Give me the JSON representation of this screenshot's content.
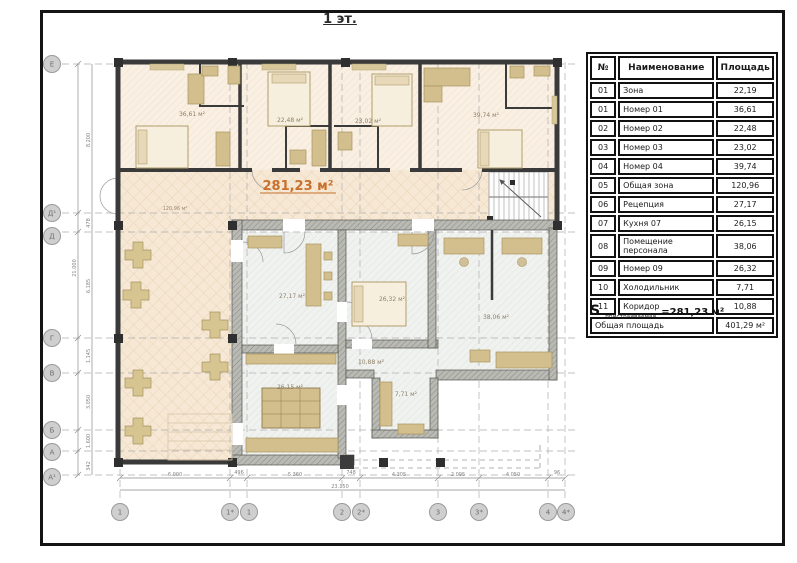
{
  "title": "1 эт.",
  "accent_color": "#c8702d",
  "legend_table": {
    "headers": [
      "№",
      "Наименование",
      "Площадь"
    ],
    "rows": [
      {
        "num": "01",
        "name": "Зона",
        "area": "22,19"
      },
      {
        "num": "01",
        "name": "Номер 01",
        "area": "36,61"
      },
      {
        "num": "02",
        "name": "Номер 02",
        "area": "22,48"
      },
      {
        "num": "03",
        "name": "Номер 03",
        "area": "23,02"
      },
      {
        "num": "04",
        "name": "Номер 04",
        "area": "39,74"
      },
      {
        "num": "05",
        "name": "Общая зона",
        "area": "120,96"
      },
      {
        "num": "06",
        "name": "Рецепция",
        "area": "27,17"
      },
      {
        "num": "07",
        "name": "Кухня 07",
        "area": "26,15"
      },
      {
        "num": "08",
        "name": "Помещение персонала",
        "area": "38,06"
      },
      {
        "num": "09",
        "name": "Номер 09",
        "area": "26,32"
      },
      {
        "num": "10",
        "name": "Холодильник",
        "area": "7,71"
      },
      {
        "num": "11",
        "name": "Коридор",
        "area": "10,88"
      }
    ],
    "footer": {
      "name": "Общая площадь",
      "area": "401,29 м²"
    }
  },
  "s_annotation": {
    "symbol": "S",
    "subscript": "пристраиваемая",
    "value": "=281,23 м²"
  },
  "plan": {
    "highlight_area_label": "281,23 м²",
    "room_labels": [
      {
        "room": "Номер 01",
        "text": "36,61 м²"
      },
      {
        "room": "Номер 02",
        "text": "22,48 м²"
      },
      {
        "room": "Номер 03",
        "text": "23,02 м²"
      },
      {
        "room": "Номер 04",
        "text": "39,74 м²"
      },
      {
        "room": "Общая зона",
        "text": "120,96 м²"
      },
      {
        "room": "Рецепция",
        "text": "27,17 м²"
      },
      {
        "room": "Номер 09",
        "text": "26,32 м²"
      },
      {
        "room": "Помещение персонала",
        "text": "38,06 м²"
      },
      {
        "room": "Коридор",
        "text": "10,88 м²"
      },
      {
        "room": "Кухня",
        "text": "26,15 м²"
      },
      {
        "room": "Холодильник",
        "text": "7,71 м²"
      }
    ],
    "axes": {
      "left": [
        "Е",
        "Д¹",
        "Д",
        "Г",
        "В",
        "Б",
        "А",
        "А¹"
      ],
      "bottom": [
        "1",
        "1*",
        "1",
        "2",
        "2*",
        "3",
        "3*",
        "4",
        "4*"
      ]
    },
    "dimensions": {
      "bottom": [
        "6.000",
        "496",
        "5.360",
        "748",
        "4.305",
        "2.095",
        "4.050",
        "96"
      ],
      "bottom_total": "23.150",
      "left": [
        "8.200",
        "478",
        "6.185",
        "1.145",
        "3.050",
        "1.600",
        "342"
      ],
      "left_total": "21.000"
    }
  }
}
